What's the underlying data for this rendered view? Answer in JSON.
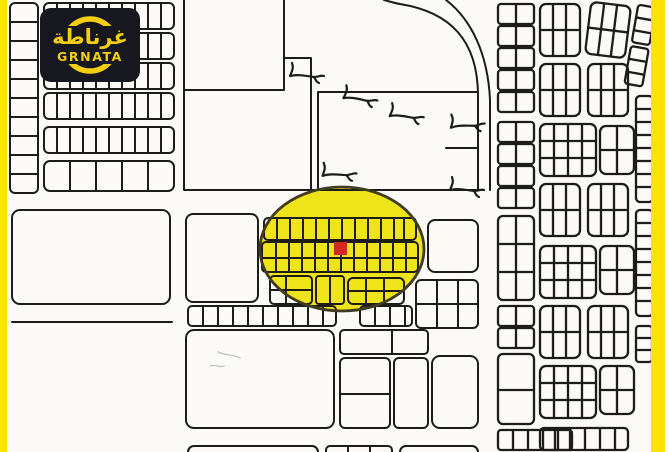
{
  "meta": {
    "description": "Real-estate cadastral plot map with highlighted area and plot marker",
    "width": 668,
    "height": 452
  },
  "logo": {
    "arabic": "غرناطة",
    "latin": "GRNATA"
  },
  "colors": {
    "frame_yellow": "#fde303",
    "highlight_yellow": "#efe41a",
    "highlight_outline": "#403c20",
    "marker_red": "#d2281e",
    "logo_bg": "#17171f",
    "logo_yellow": "#f3cf0f",
    "line_black": "#1d1c1a",
    "paper": "#fbfaf7"
  },
  "map": {
    "highlight": {
      "shape": "ellipse",
      "cx": 342,
      "cy": 249,
      "rx": 82,
      "ry": 62
    },
    "marker": {
      "shape": "square",
      "x": 334,
      "y": 242,
      "size": 13
    }
  }
}
